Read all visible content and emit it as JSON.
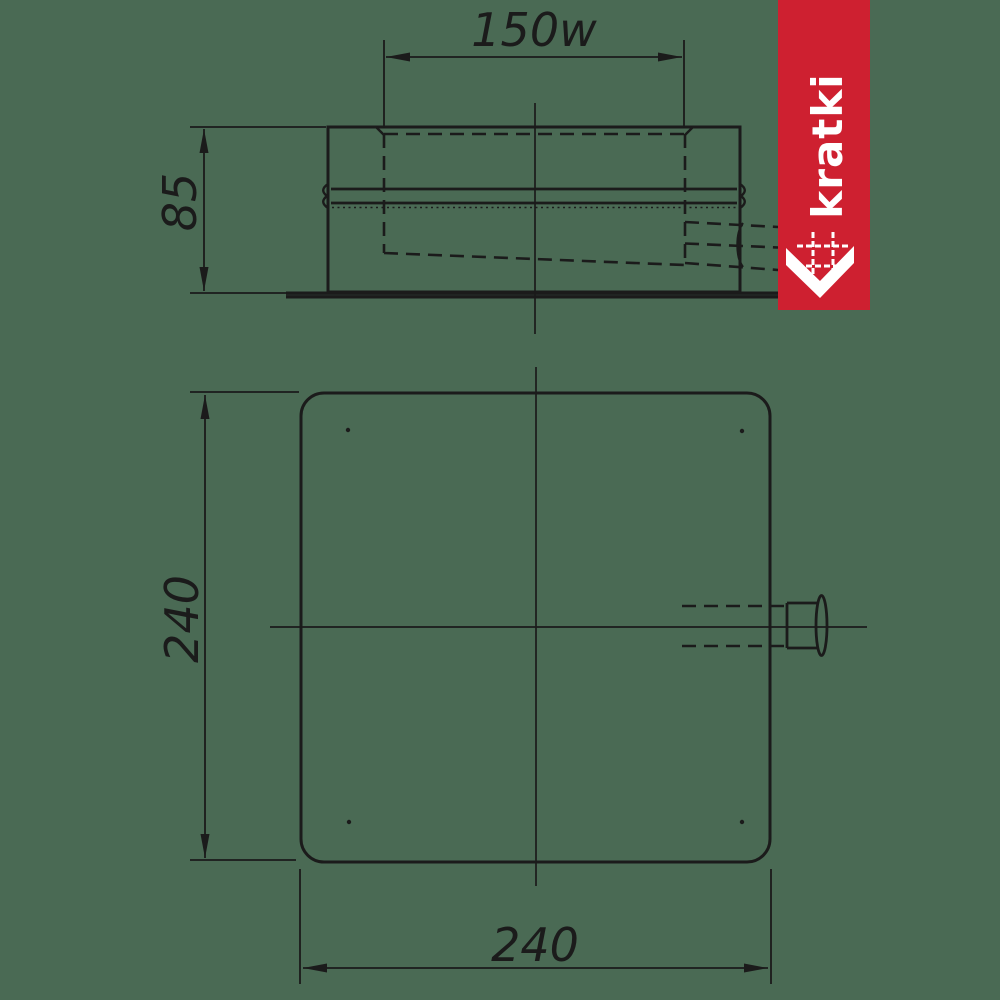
{
  "page": {
    "background_color": "#4a6a54"
  },
  "drawing": {
    "line_color": "#1b1b1b",
    "side_view": {
      "description": "side elevation of chimney base with spigot and side outlet",
      "width_label": "150w",
      "height_label": "85"
    },
    "plan_view": {
      "description": "bottom plan of square base plate with side outlet spigot",
      "height_label": "240",
      "width_label": "240"
    }
  },
  "brand": {
    "name": "kratki",
    "banner_color": "#ce2030",
    "text_color": "#ffffff",
    "logo_mark": "grate-arrow-down-icon"
  }
}
